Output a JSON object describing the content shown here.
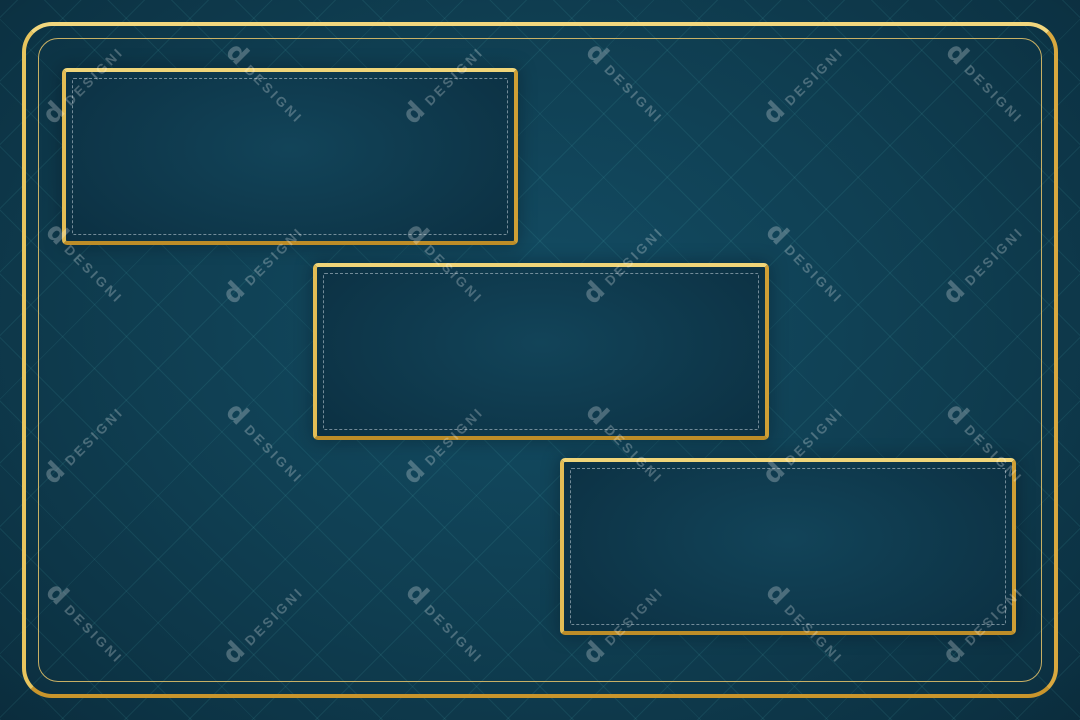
{
  "watermark": {
    "logo_glyph": "d",
    "label": "DESIGNI"
  },
  "palette": {
    "background": "#0f3d50",
    "background_center": "#134d64",
    "background_edge": "#0a2b3b",
    "gold_light": "#f6e492",
    "gold": "#d9ab45",
    "gold_dark": "#9c6f1e",
    "panel_center": "#124459",
    "panel_edge": "#0b2e40",
    "dashed_border": "rgba(198,212,220,0.55)",
    "lattice_line": "rgba(86,196,196,0.10)",
    "watermark_color": "rgba(255,255,255,0.25)"
  },
  "panels": [
    {
      "name": "panel-top-left"
    },
    {
      "name": "panel-center"
    },
    {
      "name": "panel-bottom-right"
    }
  ]
}
